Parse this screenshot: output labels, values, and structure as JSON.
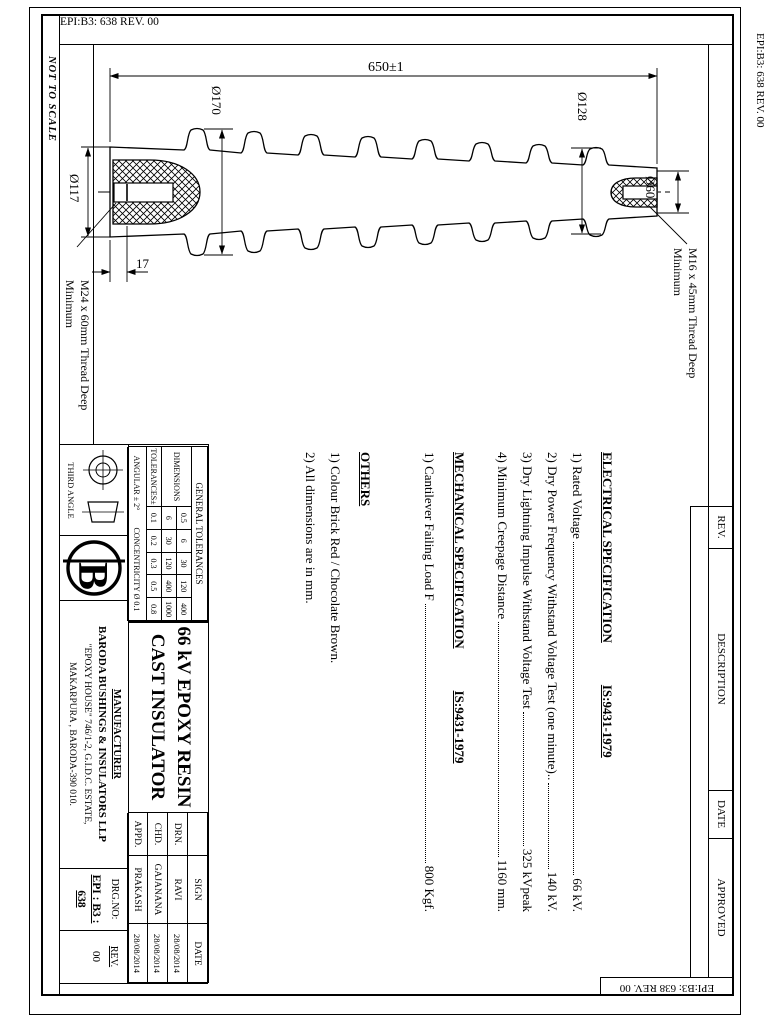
{
  "sheet": {
    "code_top": "EPI:B3: 638  REV. 00",
    "code_right": "EPI:B3: 638 REV. 00",
    "code_bottom": "EPI:B3: 638 REV. 00",
    "not_to_scale": "NOT TO SCALE"
  },
  "dims": {
    "length": "650±1",
    "d170": "Ø170",
    "d128": "Ø128",
    "d60": "Ø60",
    "d117": "Ø117",
    "lip": "17",
    "m24_l1": "M24 x 60mm Thread Deep",
    "m24_l2": "Minimum",
    "m16_l1": "M16 x 45mm Thread Deep",
    "m16_l2": "Minimum"
  },
  "revision": {
    "rev": "REV.",
    "description": "DESCRIPTION",
    "date": "DATE",
    "approved": "APPROVED"
  },
  "specs": {
    "electrical_title": "ELECTRICAL SPECIFICATION",
    "electrical_std": "IS:9431-1979",
    "electrical": [
      {
        "label": "1) Rated Voltage",
        "value": "66 kV."
      },
      {
        "label": "2) Dry Power Frequency Withstand Voltage Test (one minute)..",
        "value": "140 kV."
      },
      {
        "label": "3) Dry Lightning Impulse Withstand Voltage Test",
        "value": "325 kVpeak"
      },
      {
        "label": "4) Minimum Creepage Distance",
        "value": "1160 mm."
      }
    ],
    "mechanical_title": "MECHANICAL SPECIFICATION",
    "mechanical_std": "IS:9431-1979",
    "mechanical": [
      {
        "label": "1) Cantilever Failing Load F",
        "value": "800 Kgf."
      }
    ],
    "others_title": "OTHERS",
    "others": [
      "1) Colour Brick Red / Chocolate Brown.",
      "2) All dimensions are in mm."
    ]
  },
  "tolerances": {
    "title": "GENERAL TOLERANCES",
    "dims_label": "DIMENSIONS",
    "row1": [
      "0.5",
      "6",
      "30",
      "120",
      "400"
    ],
    "row2": [
      "6",
      "30",
      "120",
      "400",
      "1000"
    ],
    "tol_label": "TOLERANCES±",
    "tols": [
      "0.1",
      "0.2",
      "0.3",
      "0.5",
      "0.8"
    ],
    "angular": "ANGULAR ± 2°",
    "concentricity": "CONCENTRICITY Ø 0.1"
  },
  "title_block": {
    "projection": "THIRD ANGLE",
    "logo_letter": "B",
    "title_line1": "66 kV EPOXY RESIN",
    "title_line2": "CAST INSULATOR",
    "manufacturer_label": "MANUFACTURER",
    "company": "BARODA BUSHINGS & INSULATORS LLP",
    "address1": "\"EPOXY HOUSE\" 746/1-2, G.I.D.C. ESTATE,",
    "address2": "MAKARPURA , BARODA-390 010.",
    "drg_no_label": "DRG.NO:",
    "drg_no": "EPI : B3 : 638",
    "rev_label": "REV.",
    "rev_value": "00"
  },
  "sign_table": {
    "headers": [
      "",
      "SIGN",
      "DATE"
    ],
    "rows": [
      [
        "DRN.",
        "RAVI",
        "28/08/2014"
      ],
      [
        "CHD.",
        "GAJANANA",
        "28/08/2014"
      ],
      [
        "APPD.",
        "PRAKASH",
        "28/08/2014"
      ]
    ]
  }
}
